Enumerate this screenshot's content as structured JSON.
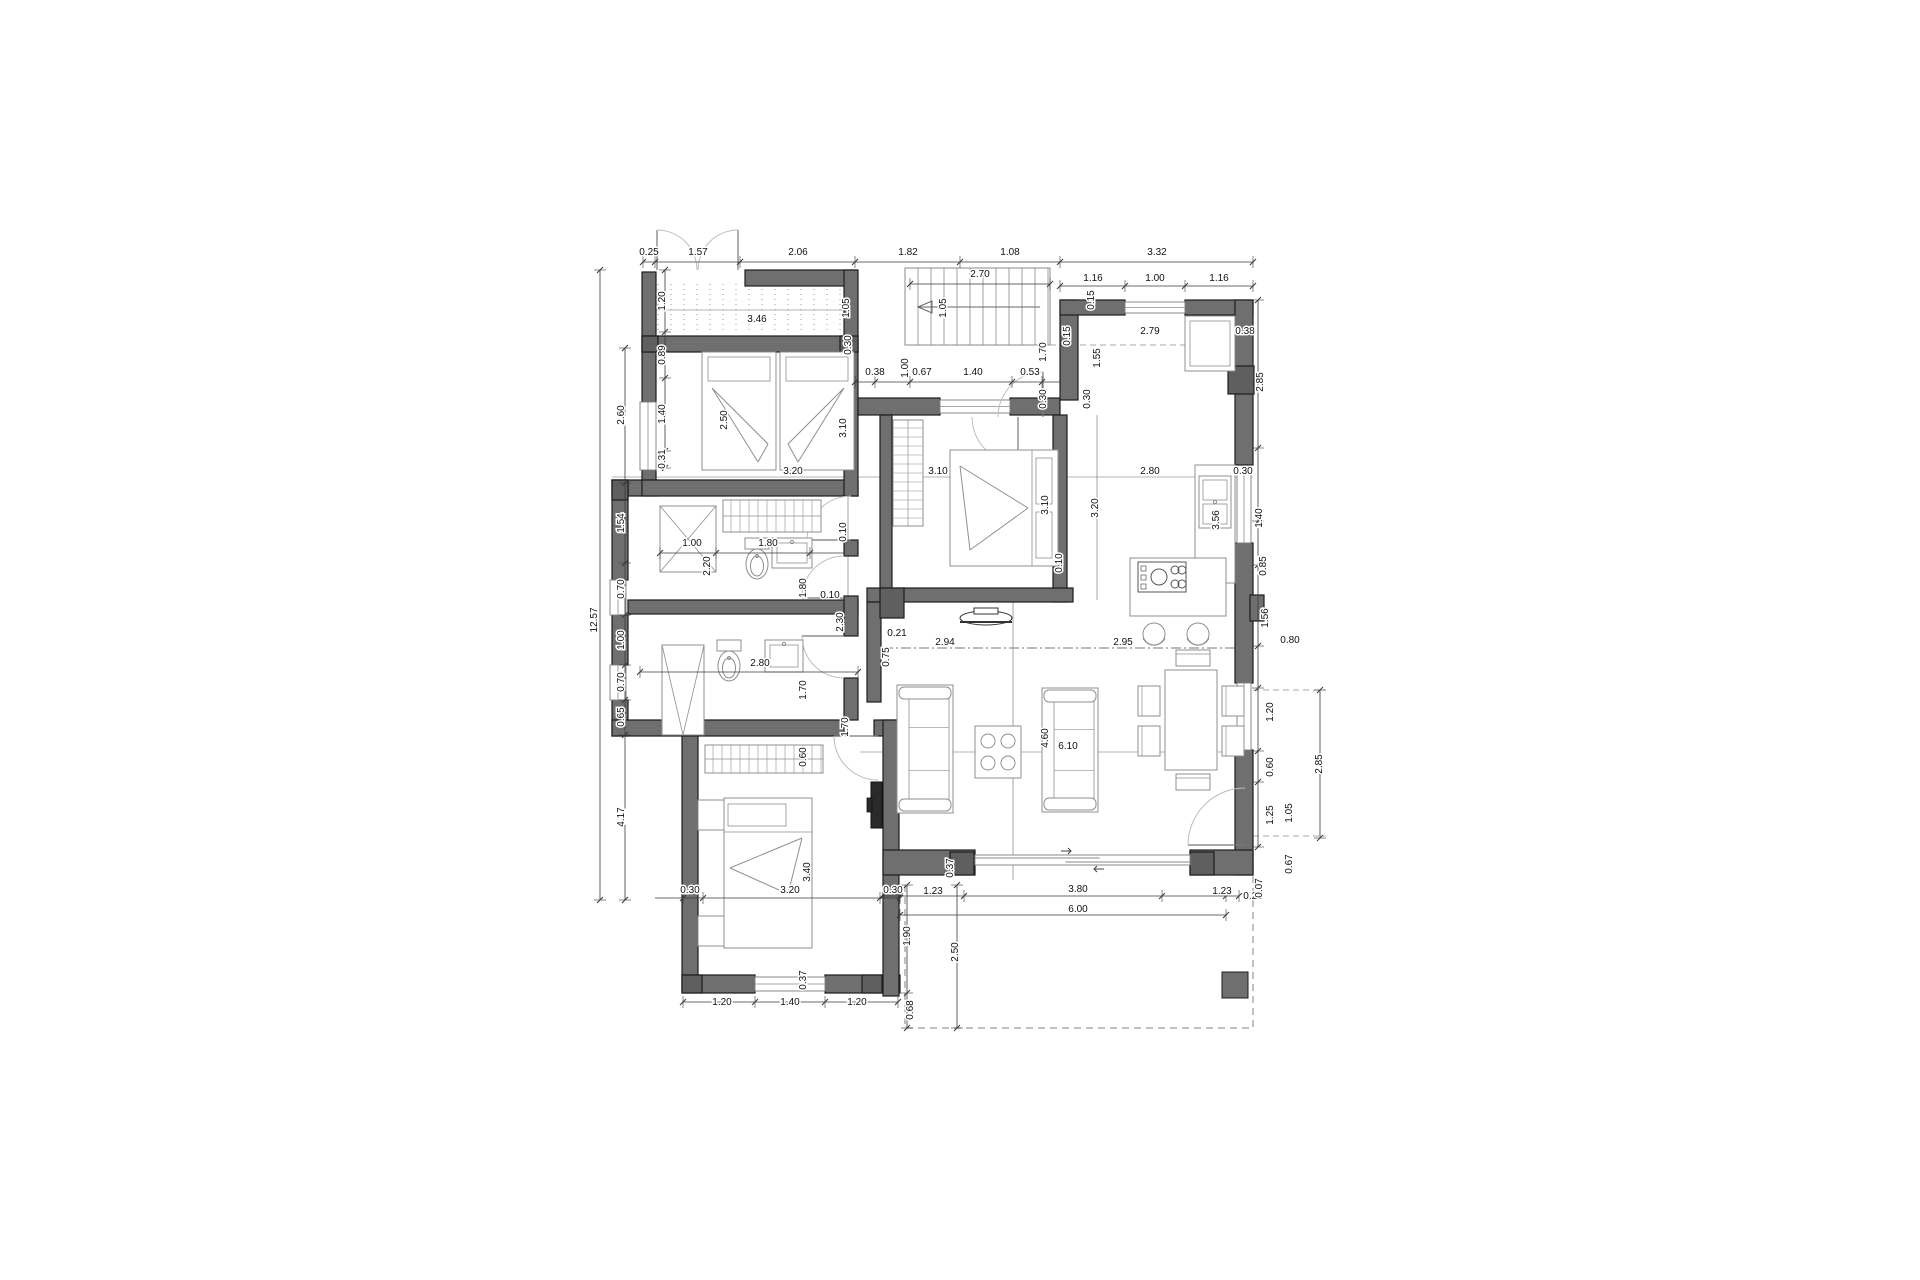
{
  "title": "apartment-floor-plan",
  "colors": {
    "background": "#ffffff",
    "wall_fill": "#6f6f6f",
    "wall_stroke": "#1d1d1d",
    "post_fill": "#5f5f5f",
    "dim_line": "#3a3a3a",
    "furniture_line": "#8f8f8f",
    "thin_line": "#6a6a6a",
    "dashed_line": "#aaaaaa",
    "dark_item": "#2a2a2a",
    "text": "#111111"
  },
  "dimension_labels": [
    {
      "t": "0.25",
      "x": 649,
      "y": 255
    },
    {
      "t": "1.57",
      "x": 698,
      "y": 255
    },
    {
      "t": "2.06",
      "x": 798,
      "y": 255
    },
    {
      "t": "1.82",
      "x": 908,
      "y": 255
    },
    {
      "t": "1.08",
      "x": 1010,
      "y": 255
    },
    {
      "t": "3.32",
      "x": 1157,
      "y": 255
    },
    {
      "t": "2.70",
      "x": 980,
      "y": 277
    },
    {
      "t": "1.16",
      "x": 1093,
      "y": 281
    },
    {
      "t": "1.00",
      "x": 1155,
      "y": 281
    },
    {
      "t": "1.16",
      "x": 1219,
      "y": 281
    },
    {
      "t": "3.46",
      "x": 757,
      "y": 322
    },
    {
      "t": "1.05",
      "x": 849,
      "y": 308,
      "r": 1
    },
    {
      "t": "1.05",
      "x": 946,
      "y": 308,
      "r": 1
    },
    {
      "t": "0.30",
      "x": 851,
      "y": 345,
      "r": 1
    },
    {
      "t": "2.79",
      "x": 1150,
      "y": 334
    },
    {
      "t": "0.38",
      "x": 1245,
      "y": 334
    },
    {
      "t": "0.15",
      "x": 1070,
      "y": 336,
      "r": 1
    },
    {
      "t": "0.15",
      "x": 1094,
      "y": 300,
      "r": 1
    },
    {
      "t": "1.70",
      "x": 1046,
      "y": 352,
      "r": 1
    },
    {
      "t": "1.55",
      "x": 1100,
      "y": 358,
      "r": 1
    },
    {
      "t": "2.85",
      "x": 1263,
      "y": 382,
      "r": 1
    },
    {
      "t": "1.00",
      "x": 908,
      "y": 368,
      "r": 1
    },
    {
      "t": "0.38",
      "x": 875,
      "y": 375
    },
    {
      "t": "0.67",
      "x": 922,
      "y": 375
    },
    {
      "t": "1.40",
      "x": 973,
      "y": 375
    },
    {
      "t": "0.53",
      "x": 1030,
      "y": 375
    },
    {
      "t": "0.30",
      "x": 1046,
      "y": 399,
      "r": 1
    },
    {
      "t": "0.30",
      "x": 1090,
      "y": 399,
      "r": 1
    },
    {
      "t": "12.57",
      "x": 597,
      "y": 620,
      "r": 1
    },
    {
      "t": "1.20",
      "x": 665,
      "y": 301,
      "r": 1
    },
    {
      "t": "0.89",
      "x": 665,
      "y": 355,
      "r": 1
    },
    {
      "t": "1.40",
      "x": 665,
      "y": 414,
      "r": 1
    },
    {
      "t": "0.31",
      "x": 665,
      "y": 459,
      "r": 1
    },
    {
      "t": "2.60",
      "x": 624,
      "y": 415,
      "r": 1
    },
    {
      "t": "1.54",
      "x": 624,
      "y": 523,
      "r": 1
    },
    {
      "t": "0.70",
      "x": 624,
      "y": 589,
      "r": 1
    },
    {
      "t": "1.00",
      "x": 624,
      "y": 640,
      "r": 1
    },
    {
      "t": "0.70",
      "x": 624,
      "y": 682,
      "r": 1
    },
    {
      "t": "0.65",
      "x": 624,
      "y": 717,
      "r": 1
    },
    {
      "t": "4.17",
      "x": 624,
      "y": 817,
      "r": 1
    },
    {
      "t": "2.50",
      "x": 727,
      "y": 420,
      "r": 1
    },
    {
      "t": "3.10",
      "x": 846,
      "y": 428,
      "r": 1
    },
    {
      "t": "3.20",
      "x": 793,
      "y": 474
    },
    {
      "t": "1.00",
      "x": 692,
      "y": 546
    },
    {
      "t": "1.80",
      "x": 768,
      "y": 546
    },
    {
      "t": "2.20",
      "x": 710,
      "y": 566,
      "r": 1
    },
    {
      "t": "1.80",
      "x": 806,
      "y": 588,
      "r": 1
    },
    {
      "t": "0.10",
      "x": 846,
      "y": 532,
      "r": 1
    },
    {
      "t": "0.10",
      "x": 830,
      "y": 598
    },
    {
      "t": "2.30",
      "x": 843,
      "y": 622,
      "r": 1
    },
    {
      "t": "3.10",
      "x": 938,
      "y": 474
    },
    {
      "t": "3.10",
      "x": 1048,
      "y": 505,
      "r": 1
    },
    {
      "t": "3.20",
      "x": 1098,
      "y": 508,
      "r": 1
    },
    {
      "t": "0.10",
      "x": 1062,
      "y": 563,
      "r": 1
    },
    {
      "t": "2.80",
      "x": 1150,
      "y": 474
    },
    {
      "t": "0.30",
      "x": 1243,
      "y": 474
    },
    {
      "t": "1.40",
      "x": 1262,
      "y": 518,
      "r": 1
    },
    {
      "t": "3.56",
      "x": 1219,
      "y": 520,
      "r": 1
    },
    {
      "t": "0.85",
      "x": 1266,
      "y": 566,
      "r": 1
    },
    {
      "t": "2.95",
      "x": 1123,
      "y": 645
    },
    {
      "t": "2.94",
      "x": 945,
      "y": 645
    },
    {
      "t": "0.21",
      "x": 897,
      "y": 636
    },
    {
      "t": "0.75",
      "x": 889,
      "y": 657,
      "r": 1
    },
    {
      "t": "1.56",
      "x": 1268,
      "y": 618,
      "r": 1
    },
    {
      "t": "0.80",
      "x": 1290,
      "y": 643
    },
    {
      "t": "4.60",
      "x": 1048,
      "y": 738,
      "r": 1
    },
    {
      "t": "6.10",
      "x": 1068,
      "y": 749
    },
    {
      "t": "2.80",
      "x": 760,
      "y": 666
    },
    {
      "t": "1.70",
      "x": 806,
      "y": 690,
      "r": 1
    },
    {
      "t": "1.70",
      "x": 848,
      "y": 727,
      "r": 1
    },
    {
      "t": "0.60",
      "x": 806,
      "y": 757,
      "r": 1
    },
    {
      "t": "3.40",
      "x": 810,
      "y": 872,
      "r": 1
    },
    {
      "t": "3.20",
      "x": 790,
      "y": 893
    },
    {
      "t": "0.30",
      "x": 690,
      "y": 893
    },
    {
      "t": "0.30",
      "x": 893,
      "y": 893
    },
    {
      "t": "0.37",
      "x": 953,
      "y": 868,
      "r": 1
    },
    {
      "t": "0.37",
      "x": 806,
      "y": 980,
      "r": 1
    },
    {
      "t": "1.20",
      "x": 722,
      "y": 1005
    },
    {
      "t": "1.40",
      "x": 790,
      "y": 1005
    },
    {
      "t": "1.20",
      "x": 857,
      "y": 1005
    },
    {
      "t": "1.23",
      "x": 933,
      "y": 894
    },
    {
      "t": "3.80",
      "x": 1078,
      "y": 892
    },
    {
      "t": "1.23",
      "x": 1222,
      "y": 894
    },
    {
      "t": "0.25",
      "x": 1253,
      "y": 899
    },
    {
      "t": "6.00",
      "x": 1078,
      "y": 912
    },
    {
      "t": "1.90",
      "x": 910,
      "y": 936,
      "r": 1
    },
    {
      "t": "2.50",
      "x": 958,
      "y": 952,
      "r": 1
    },
    {
      "t": "0.68",
      "x": 913,
      "y": 1010,
      "r": 1
    },
    {
      "t": "1.20",
      "x": 1273,
      "y": 712,
      "r": 1
    },
    {
      "t": "0.60",
      "x": 1273,
      "y": 767,
      "r": 1
    },
    {
      "t": "1.25",
      "x": 1273,
      "y": 815,
      "r": 1
    },
    {
      "t": "0.07",
      "x": 1262,
      "y": 888,
      "r": 1
    },
    {
      "t": "1.05",
      "x": 1292,
      "y": 813,
      "r": 1
    },
    {
      "t": "0.67",
      "x": 1292,
      "y": 864,
      "r": 1
    },
    {
      "t": "2.85",
      "x": 1322,
      "y": 764,
      "r": 1
    }
  ],
  "walls": [
    [
      642,
      272,
      14,
      80
    ],
    [
      745,
      270,
      112,
      16
    ],
    [
      642,
      336,
      216,
      16
    ],
    [
      844,
      270,
      14,
      82
    ],
    [
      642,
      352,
      14,
      50
    ],
    [
      642,
      470,
      14,
      14
    ],
    [
      612,
      480,
      46,
      16
    ],
    [
      612,
      480,
      16,
      100
    ],
    [
      612,
      615,
      16,
      50
    ],
    [
      612,
      700,
      16,
      36
    ],
    [
      642,
      480,
      216,
      16
    ],
    [
      844,
      352,
      14,
      144
    ],
    [
      628,
      600,
      230,
      14
    ],
    [
      844,
      540,
      14,
      16
    ],
    [
      844,
      596,
      14,
      40
    ],
    [
      844,
      678,
      14,
      42
    ],
    [
      612,
      720,
      232,
      16
    ],
    [
      874,
      720,
      28,
      16
    ],
    [
      682,
      736,
      16,
      256
    ],
    [
      682,
      975,
      73,
      18
    ],
    [
      825,
      975,
      75,
      18
    ],
    [
      883,
      720,
      16,
      276
    ],
    [
      858,
      398,
      82,
      17
    ],
    [
      1010,
      398,
      50,
      17
    ],
    [
      880,
      415,
      12,
      187
    ],
    [
      1053,
      415,
      14,
      187
    ],
    [
      1060,
      300,
      18,
      100
    ],
    [
      1060,
      300,
      65,
      15
    ],
    [
      1185,
      300,
      68,
      15
    ],
    [
      1235,
      300,
      18,
      165
    ],
    [
      1235,
      543,
      18,
      140
    ],
    [
      1250,
      595,
      14,
      26
    ],
    [
      1235,
      750,
      18,
      125
    ],
    [
      867,
      588,
      206,
      14
    ],
    [
      867,
      602,
      14,
      100
    ],
    [
      883,
      850,
      92,
      25
    ],
    [
      1190,
      850,
      63,
      25
    ]
  ],
  "posts": [
    [
      642,
      336,
      16,
      16
    ],
    [
      840,
      336,
      18,
      16
    ],
    [
      880,
      588,
      24,
      30
    ],
    [
      1228,
      366,
      26,
      28
    ],
    [
      682,
      975,
      20,
      18
    ],
    [
      862,
      975,
      20,
      18
    ],
    [
      950,
      852,
      24,
      23
    ],
    [
      1190,
      852,
      24,
      23
    ],
    [
      612,
      480,
      16,
      20
    ]
  ],
  "windows": [
    {
      "x": 640,
      "y": 402,
      "w": 16,
      "h": 68,
      "v": 1
    },
    {
      "x": 610,
      "y": 580,
      "w": 16,
      "h": 35,
      "v": 1
    },
    {
      "x": 610,
      "y": 665,
      "w": 16,
      "h": 35,
      "v": 1
    },
    {
      "x": 755,
      "y": 977,
      "w": 70,
      "h": 14
    },
    {
      "x": 940,
      "y": 400,
      "w": 70,
      "h": 13
    },
    {
      "x": 1125,
      "y": 302,
      "w": 60,
      "h": 11
    },
    {
      "x": 1237,
      "y": 473,
      "w": 14,
      "h": 70,
      "v": 1
    },
    {
      "x": 1237,
      "y": 683,
      "w": 14,
      "h": 67,
      "v": 1
    }
  ],
  "slider": {
    "x": 975,
    "y": 855,
    "w": 215,
    "h": 10
  },
  "doors": [
    {
      "leaf": [
        657,
        270,
        657,
        230
      ],
      "arc": "M 657 230 A 40 40 0 0 1 697 270"
    },
    {
      "leaf": [
        738,
        270,
        738,
        230
      ],
      "arc": "M 738 230 A 40 40 0 0 0 698 270"
    },
    {
      "leaf": [
        1043,
        417,
        1043,
        372
      ],
      "arc": "M 1043 372 A 45 45 0 0 0 998 417"
    },
    {
      "leaf": [
        1018,
        417,
        1018,
        463
      ],
      "arc": "M 1018 463 A 46 46 0 0 1 972 417"
    },
    {
      "leaf": [
        851,
        540,
        807,
        540
      ],
      "arc": "M 807 540 A 44 44 0 0 1 851 496"
    },
    {
      "leaf": [
        844,
        598,
        802,
        598
      ],
      "arc": "M 802 598 A 42 42 0 0 1 844 556"
    },
    {
      "leaf": [
        844,
        636,
        802,
        636
      ],
      "arc": "M 802 636 A 42 42 0 0 0 844 678"
    },
    {
      "leaf": [
        878,
        736,
        834,
        736
      ],
      "arc": "M 834 736 A 44 44 0 0 0 878 780"
    },
    {
      "leaf": [
        1245,
        845,
        1188,
        845
      ],
      "arc": "M 1188 845 A 57 57 0 0 1 1245 788"
    }
  ],
  "stairs": {
    "x": 905,
    "y": 268,
    "w": 145,
    "h": 77,
    "step": 13,
    "arrow": [
      1040,
      307,
      918,
      307
    ]
  },
  "balcony_hatch": {
    "x": 658,
    "y": 284,
    "w": 186,
    "h": 48,
    "step": 13
  },
  "terrace": {
    "path": "M 905 885 L 905 1028 L 1253 1028 L 1253 788"
  },
  "thin_lines": [
    [
      612,
      477,
      1253,
      477
    ],
    [
      860,
      752,
      1243,
      752
    ],
    [
      1013,
      602,
      1013,
      880
    ],
    [
      848,
      352,
      848,
      598
    ],
    [
      1097,
      415,
      1097,
      600
    ],
    [
      655,
      310,
      855,
      310
    ]
  ],
  "dash_lines": [
    [
      1050,
      345,
      1235,
      345
    ],
    [
      1253,
      690,
      1325,
      690
    ],
    [
      1253,
      836,
      1325,
      836
    ]
  ],
  "dashdot_lines": [
    [
      883,
      648,
      1253,
      648
    ]
  ],
  "chains": [
    {
      "o": "h",
      "pos": 262,
      "from": 643,
      "to": 1253,
      "ticks": [
        643,
        655,
        740,
        855,
        960,
        1060,
        1253
      ]
    },
    {
      "o": "h",
      "pos": 286,
      "from": 1060,
      "to": 1253,
      "ticks": [
        1060,
        1125,
        1185,
        1253
      ]
    },
    {
      "o": "h",
      "pos": 284,
      "from": 910,
      "to": 1050,
      "ticks": [
        910,
        1050
      ]
    },
    {
      "o": "h",
      "pos": 382,
      "from": 855,
      "to": 1060,
      "ticks": [
        855,
        875,
        910,
        1012,
        1042
      ]
    },
    {
      "o": "h",
      "pos": 553,
      "from": 660,
      "to": 845,
      "ticks": [
        660,
        716,
        810
      ]
    },
    {
      "o": "h",
      "pos": 672,
      "from": 640,
      "to": 858,
      "ticks": [
        640,
        858
      ]
    },
    {
      "o": "h",
      "pos": 898,
      "from": 655,
      "to": 900,
      "ticks": [
        683,
        703,
        880,
        900
      ]
    },
    {
      "o": "h",
      "pos": 896,
      "from": 883,
      "to": 1239,
      "ticks": [
        883,
        900,
        964,
        1162,
        1226,
        1239
      ]
    },
    {
      "o": "h",
      "pos": 915,
      "from": 900,
      "to": 1226,
      "ticks": [
        900,
        1226
      ]
    },
    {
      "o": "h",
      "pos": 1002,
      "from": 683,
      "to": 898,
      "ticks": [
        683,
        755,
        825,
        898
      ]
    },
    {
      "o": "v",
      "pos": 600,
      "from": 270,
      "to": 900,
      "ticks": [
        270,
        900
      ]
    },
    {
      "o": "v",
      "pos": 625,
      "from": 348,
      "to": 900,
      "ticks": [
        348,
        483,
        563,
        615,
        665,
        700,
        735,
        900
      ]
    },
    {
      "o": "v",
      "pos": 665,
      "from": 270,
      "to": 468,
      "ticks": [
        270,
        332,
        378,
        451,
        468
      ]
    },
    {
      "o": "v",
      "pos": 1258,
      "from": 300,
      "to": 847,
      "ticks": [
        300,
        448,
        521,
        565,
        646,
        688,
        751,
        782,
        847
      ]
    },
    {
      "o": "v",
      "pos": 1320,
      "from": 690,
      "to": 838,
      "ticks": [
        690,
        838
      ]
    },
    {
      "o": "v",
      "pos": 907,
      "from": 885,
      "to": 1028,
      "ticks": [
        885,
        993,
        1028
      ]
    },
    {
      "o": "v",
      "pos": 957,
      "from": 885,
      "to": 1028,
      "ticks": [
        885,
        1028
      ]
    }
  ],
  "furniture": [
    {
      "t": "bed-single",
      "n": "single-bed",
      "x": 702,
      "y": 352,
      "w": 74,
      "h": 118
    },
    {
      "t": "bed-single",
      "n": "single-bed",
      "x": 780,
      "y": 352,
      "w": 74,
      "h": 118,
      "m": 1
    },
    {
      "t": "wardrobe-h",
      "n": "closet",
      "x": 723,
      "y": 500,
      "w": 98,
      "h": 32
    },
    {
      "t": "wardrobe-v",
      "n": "wardrobe",
      "x": 893,
      "y": 420,
      "w": 30,
      "h": 106
    },
    {
      "t": "wardrobe-h",
      "n": "wardrobe",
      "x": 705,
      "y": 745,
      "w": 118,
      "h": 28
    },
    {
      "t": "shower-x",
      "n": "shower",
      "x": 660,
      "y": 506,
      "w": 56,
      "h": 66
    },
    {
      "t": "toilet",
      "n": "toilet",
      "cx": 757,
      "cy": 566
    },
    {
      "t": "sink",
      "n": "washbasin",
      "x": 772,
      "y": 538,
      "w": 40,
      "h": 30
    },
    {
      "t": "shower-v",
      "n": "shower",
      "x": 662,
      "y": 645,
      "w": 42,
      "h": 90
    },
    {
      "t": "toilet",
      "n": "toilet",
      "cx": 729,
      "cy": 668
    },
    {
      "t": "sink",
      "n": "washbasin",
      "x": 765,
      "y": 640,
      "w": 38,
      "h": 32
    },
    {
      "t": "bed-double",
      "n": "double-bed",
      "x": 950,
      "y": 450,
      "w": 108,
      "h": 116
    },
    {
      "t": "table-sq",
      "n": "nightstand",
      "x": 698,
      "y": 800,
      "w": 26,
      "h": 30
    },
    {
      "t": "table-sq",
      "n": "nightstand",
      "x": 698,
      "y": 916,
      "w": 26,
      "h": 30
    },
    {
      "t": "bed-double3",
      "n": "double-bed",
      "x": 724,
      "y": 798,
      "w": 88,
      "h": 150
    },
    {
      "t": "appliance",
      "n": "boiler",
      "x": 1185,
      "y": 316,
      "w": 50,
      "h": 55
    },
    {
      "t": "counter",
      "n": "kitchen-counter",
      "x": 1195,
      "y": 465,
      "w": 40,
      "h": 118
    },
    {
      "t": "sink-k",
      "n": "kitchen-sink",
      "x": 1199,
      "y": 476,
      "w": 32,
      "h": 52
    },
    {
      "t": "island",
      "n": "kitchen-island",
      "x": 1130,
      "y": 558,
      "w": 96,
      "h": 58
    },
    {
      "t": "stove",
      "n": "cooktop",
      "x": 1138,
      "y": 562,
      "w": 48,
      "h": 30
    },
    {
      "t": "stool",
      "n": "stool",
      "cx": 1154,
      "cy": 634
    },
    {
      "t": "stool",
      "n": "stool",
      "cx": 1198,
      "cy": 634
    },
    {
      "t": "table",
      "n": "dining-table",
      "x": 1165,
      "y": 670,
      "w": 52,
      "h": 100
    },
    {
      "t": "chair",
      "n": "chair",
      "x": 1138,
      "y": 686,
      "w": 22,
      "h": 30
    },
    {
      "t": "chair",
      "n": "chair",
      "x": 1138,
      "y": 726,
      "w": 22,
      "h": 30
    },
    {
      "t": "chair",
      "n": "chair",
      "x": 1222,
      "y": 686,
      "w": 22,
      "h": 30
    },
    {
      "t": "chair",
      "n": "chair",
      "x": 1222,
      "y": 726,
      "w": 22,
      "h": 30
    },
    {
      "t": "chair-h",
      "n": "chair",
      "x": 1176,
      "y": 650,
      "w": 34,
      "h": 16
    },
    {
      "t": "chair-h",
      "n": "chair",
      "x": 1176,
      "y": 774,
      "w": 34,
      "h": 16
    },
    {
      "t": "sofa",
      "n": "sofa",
      "x": 897,
      "y": 685,
      "w": 56,
      "h": 128
    },
    {
      "t": "sofa",
      "n": "sofa",
      "x": 1042,
      "y": 688,
      "w": 56,
      "h": 124
    },
    {
      "t": "coffee",
      "n": "coffee-table",
      "x": 975,
      "y": 726,
      "w": 46,
      "h": 52
    },
    {
      "t": "tv",
      "n": "tv",
      "cx": 986,
      "cy": 612
    },
    {
      "t": "tv-wall",
      "n": "tv",
      "x": 871,
      "y": 782,
      "w": 11,
      "h": 46
    },
    {
      "t": "column",
      "n": "terrace-column",
      "x": 1222,
      "y": 972,
      "w": 26,
      "h": 26
    }
  ]
}
